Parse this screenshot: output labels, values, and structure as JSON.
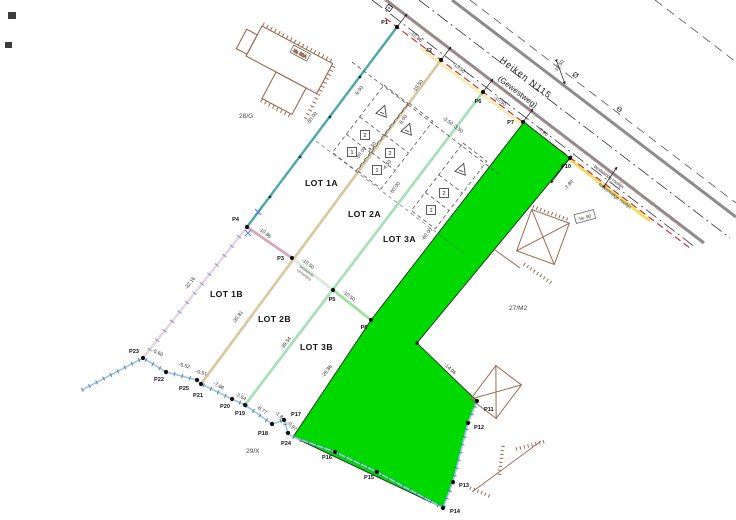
{
  "road": {
    "name_line1": "Heiken N115",
    "name_line2": "(Gewestweg)"
  },
  "parcel_labels": {
    "left": "28/G",
    "right": "27/M2",
    "bottom": "29/X"
  },
  "lot_labels": [
    "LOT 1A",
    "LOT 2A",
    "LOT 3A",
    "LOT 1B",
    "LOT 2B",
    "LOT 3B"
  ],
  "point_labels": [
    "P1",
    "42",
    "P6",
    "P7",
    "P10",
    "P4",
    "P3",
    "P5",
    "P8",
    "P11",
    "P12",
    "P13",
    "P14",
    "P15",
    "P16",
    "P17",
    "P18",
    "P19",
    "P20",
    "P21",
    "P25",
    "P22",
    "P23",
    "P24"
  ],
  "measurements": [
    "-10.86",
    "-10.50",
    "-10.50",
    "-7.80",
    "-10.86",
    "-10.50",
    "-10.50",
    "-50.00",
    "-50.00",
    "-50.00",
    "-60.00",
    "-32.16",
    "-30.81",
    "-39.54",
    "-26.86",
    "-9.00",
    "-9.00",
    "-4.50",
    "-4.50",
    "-3.50 -3.50",
    "-14.96",
    "-7.80",
    "-10.50",
    "-19.50",
    "-5.60",
    "-5.52",
    "-0.51",
    "-7.86",
    "-2.64",
    "-8.77",
    "-1.84",
    "-0.97"
  ],
  "zone_numbers": {
    "zone1": "1",
    "zone2": "2"
  },
  "house_numbers": {
    "left_building": "Nr. 92A",
    "right_building": "Nr. 90"
  },
  "annotations": {
    "future_building_line": "toekomstige rooilijn",
    "existing_building_line": "bestaande rooilijn",
    "tiny_note_line1": "bestaande",
    "tiny_note_line2": "verharding"
  },
  "symbols": {
    "pole": "Ø",
    "circle_dash": "⊖"
  },
  "colors": {
    "parcel_green": "#00d900",
    "road_gray": "#8c8c8c",
    "building_line_red": "#cc2222",
    "boundary_teal": "#4aa8a8",
    "lot_line_tan": "#d9c9a3",
    "lot_line_green": "#a9dfb9",
    "lot_line_pink": "#e6d6de",
    "split_mauve": "#d2aabb",
    "stream_blue": "#9cc4e4",
    "tick_blue": "#4a6fd0",
    "building_brown": "#9a6a50",
    "highlight_yellow": "#e6d44a"
  }
}
